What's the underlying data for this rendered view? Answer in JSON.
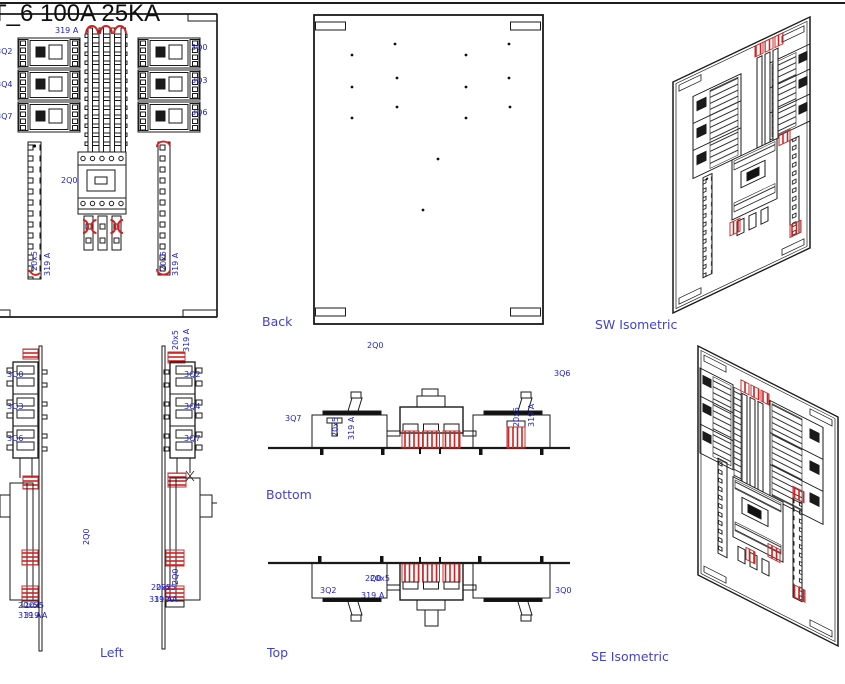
{
  "title": "T_6 100A 25KA",
  "colors": {
    "label_blue": "#2424c2",
    "caption_blue": "#4343c8",
    "accent_red": "#d42020",
    "line_black": "#1a1a1a"
  },
  "captions": {
    "back": "Back",
    "bottom": "Bottom",
    "left": "Left",
    "top": "Top",
    "sw_iso": "SW Isometric",
    "se_iso": "SE Isometric"
  },
  "labels": {
    "main_breaker": "2Q0",
    "bus_size": "20x5",
    "bus_rating": "319 A",
    "front_left": [
      "3Q2",
      "3Q4",
      "3Q7"
    ],
    "front_right": [
      "3Q0",
      "3Q3",
      "3Q6"
    ]
  }
}
